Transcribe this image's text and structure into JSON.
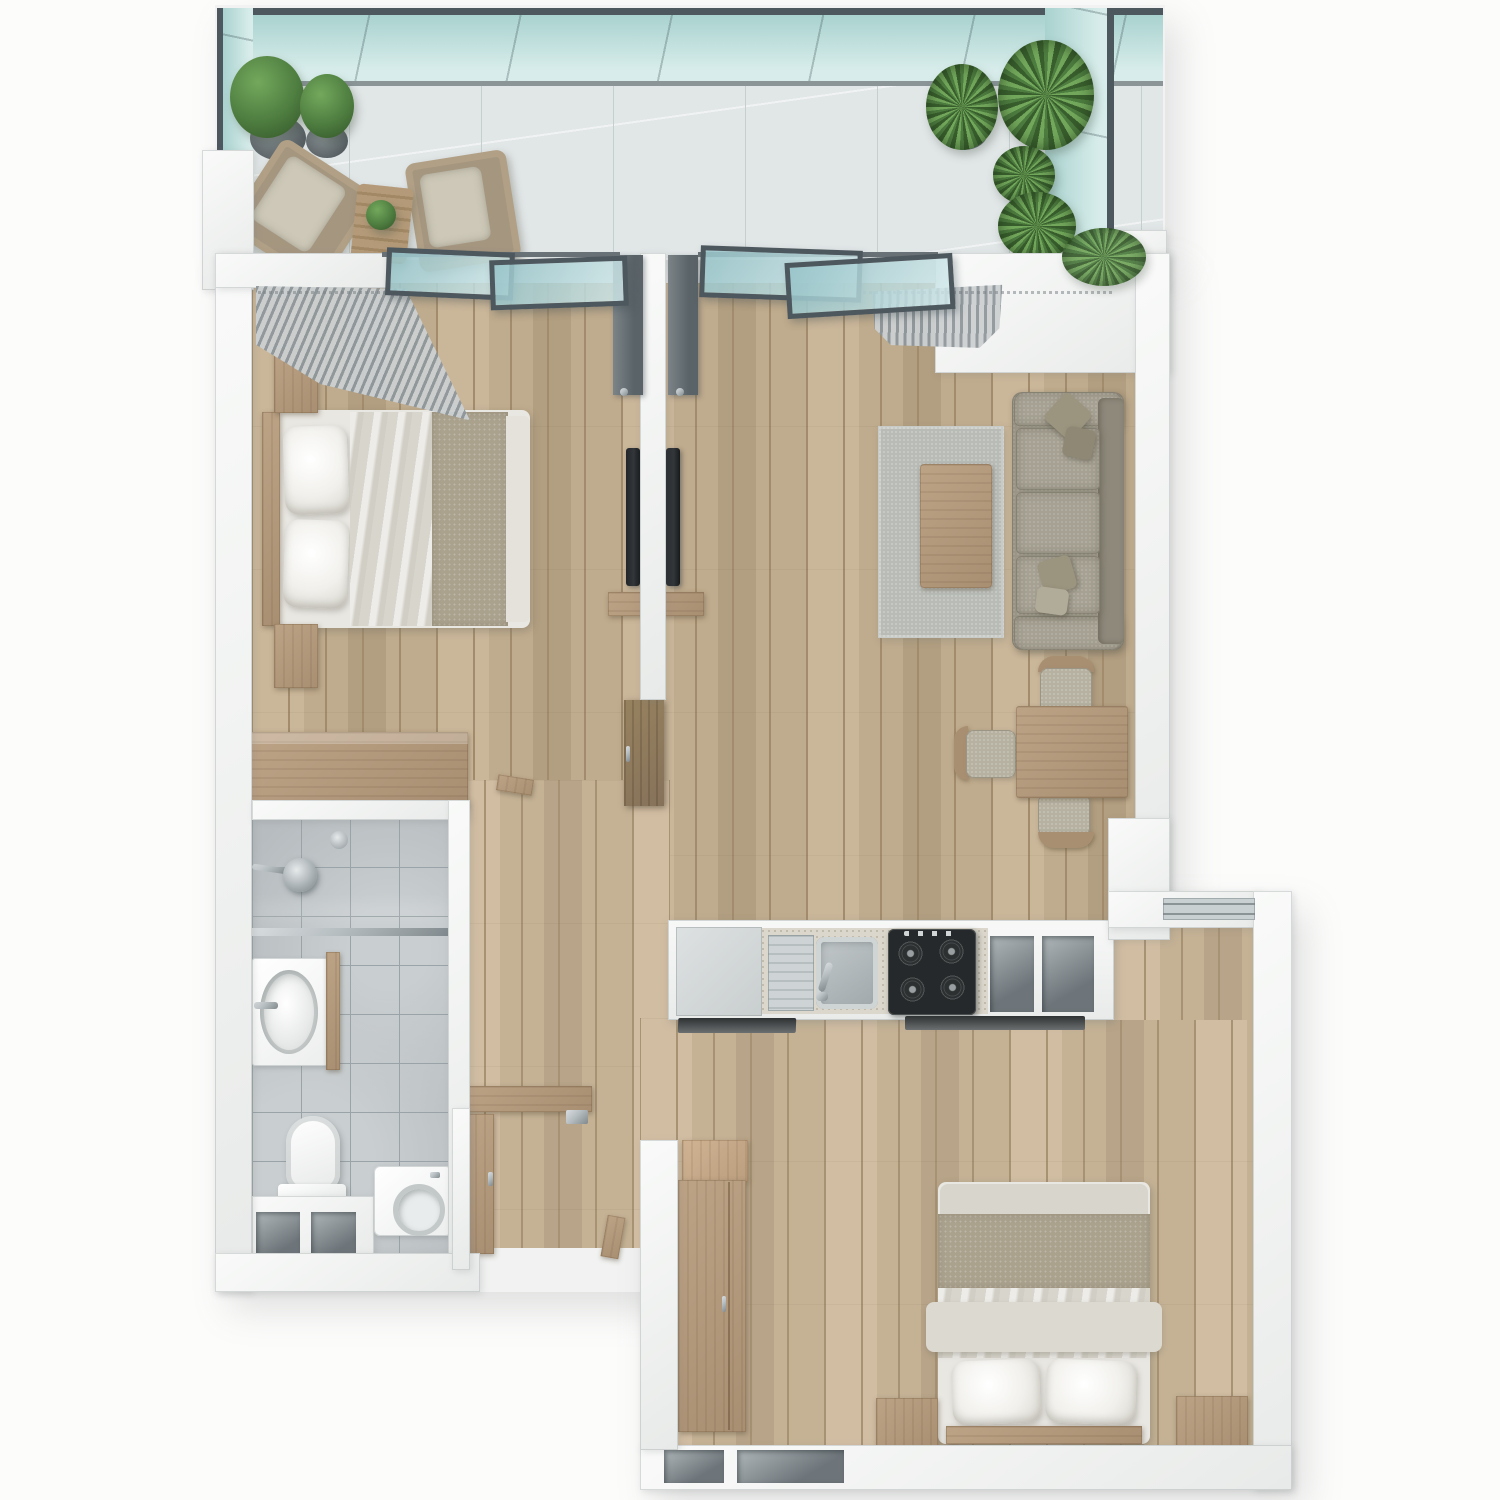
{
  "meta": {
    "title": "Two-bedroom apartment 3D floor plan, top-down render",
    "view": "top-down",
    "render_style": "photorealistic architectural visualization, no text labels"
  },
  "palette": {
    "wall_hi": "#f9faf9",
    "wall_lo": "#e8eae9",
    "wood": "#bfab8d",
    "wood_light": "#cab699",
    "wood_mid": "#b29e80",
    "wood_line": "#a28c6d",
    "tile": "#b6bcbf",
    "tile_line": "#9aa3a7",
    "tile_light": "#c9ced0",
    "balcony_floor": "#e1e6e7",
    "balcony_line": "#c6ced0",
    "glass": "#a9d2cf",
    "glass_light": "#d8edeb",
    "glass_frame": "#4d575e",
    "steel": "#b6bdc0",
    "steel_dark": "#80898d",
    "stove": "#26292b",
    "granite": "#dbd7cc",
    "fabric": "#a6a193",
    "fabric_dark": "#8e897b",
    "fabric_light": "#b6b1a1",
    "rug": "#b8bbb6",
    "furn_wood": "#a98f72",
    "furn_wood_light": "#bda386",
    "cabinet_dark": "#86725a",
    "linen_white": "#f1f0ec",
    "linen_sheet": "#d8d5cd",
    "linen_blanket": "#aba28e",
    "curtain_dark": "#8f979b",
    "curtain_light": "#ccd0d1",
    "plant": "#4e7d40",
    "plant_light": "#73a85c",
    "plant_dark": "#395e2d",
    "tv": "#33373a"
  },
  "rooms": {
    "balcony": {
      "label": "Balcony",
      "items": [
        "teal glass railing",
        "two topiary pots",
        "palm and fern pots",
        "two lounge chairs",
        "slatted side table with small plant"
      ]
    },
    "bedroom1": {
      "label": "Bedroom 1",
      "items": [
        "double bed with white pillows and taupe throw",
        "two nightstands",
        "dresser",
        "corner curtains",
        "wall-mounted TV",
        "sliding balcony door"
      ]
    },
    "living_room": {
      "label": "Living room",
      "items": [
        "three-seat sofa with four cushions",
        "gray area rug",
        "wooden coffee table",
        "wall-mounted TV",
        "media console",
        "curtains",
        "sliding balcony door"
      ]
    },
    "dining": {
      "label": "Dining nook",
      "items": [
        "square wooden table",
        "three chairs with curved wood backs"
      ]
    },
    "kitchen": {
      "label": "Kitchen",
      "items": [
        "fridge / tall cabinet",
        "sink with drainboard and faucet",
        "black four-burner gas hob",
        "two counter niches",
        "base cabinets"
      ]
    },
    "bathroom": {
      "label": "Bathroom",
      "items": [
        "walk-in shower with glass screen",
        "two shower heads",
        "vanity with oval basin",
        "toilet",
        "washing machine",
        "two storage niches"
      ]
    },
    "hallway": {
      "label": "Hallway",
      "items": [
        "wall shelf",
        "open entry door",
        "bedroom door leaf"
      ]
    },
    "bedroom2": {
      "label": "Bedroom 2",
      "items": [
        "double bed with two white pillows",
        "two nightstands",
        "wardrobe",
        "shoe cabinet",
        "window",
        "two storage niches"
      ]
    }
  }
}
